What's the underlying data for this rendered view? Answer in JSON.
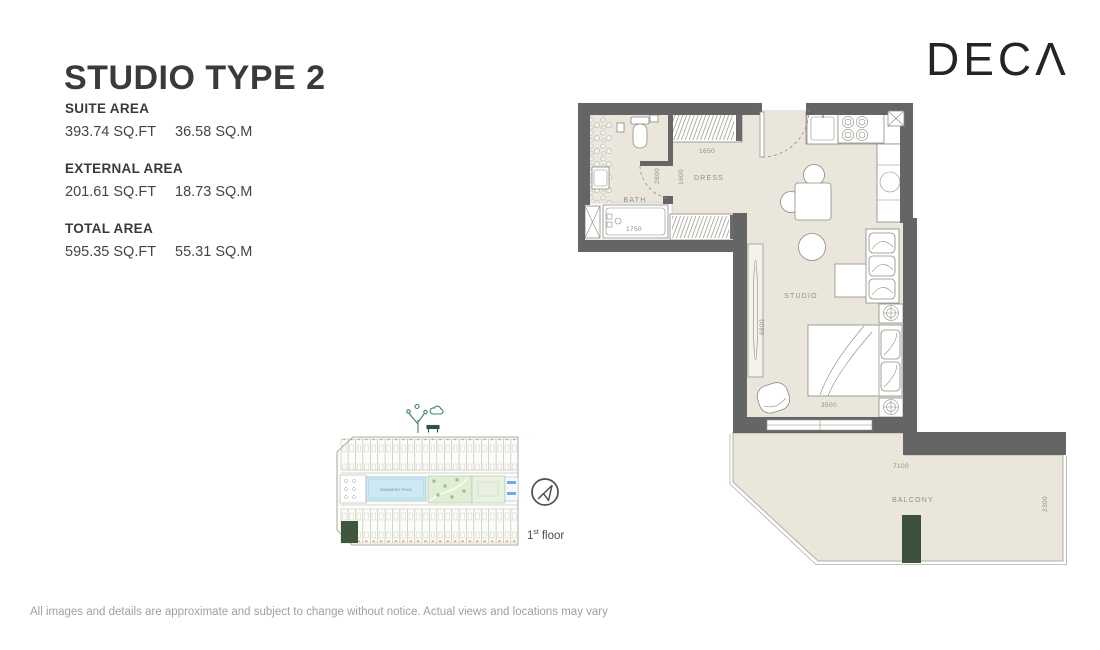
{
  "header": {
    "title": "STUDIO TYPE 2",
    "brand": "DECΛ"
  },
  "areas": [
    {
      "label": "SUITE AREA",
      "sqft": "393.74 SQ.FT",
      "sqm": "36.58 SQ.M"
    },
    {
      "label": "EXTERNAL AREA",
      "sqft": "201.61 SQ.FT",
      "sqm": "18.73 SQ.M"
    },
    {
      "label": "TOTAL AREA",
      "sqft": "595.35 SQ.FT",
      "sqm": "55.31 SQ.M"
    }
  ],
  "floor_plan": {
    "labels": {
      "bath": "BATH",
      "dress": "DRESS",
      "studio": "STUDIO",
      "balcony": "BALCONY"
    },
    "dims": {
      "wardrobe": "1650",
      "dress_width": "2800",
      "dress_length": "1600",
      "bath_length": "1750",
      "studio_length": "6800",
      "studio_width": "3500",
      "balcony_width": "7100",
      "balcony_depth": "2300"
    }
  },
  "key_plan": {
    "pool_label": "SWIMMING POOL",
    "floor_num": "1",
    "floor_sup": "st",
    "floor_word": "floor"
  },
  "footer": {
    "disclaimer": "All images and details are approximate and subject to change without notice. Actual views and locations may vary"
  },
  "colors": {
    "wall": "#656565",
    "floor": "#ebe6dc",
    "accent_green": "#3d5140",
    "pool_blue": "#cde8f3",
    "label_gray": "#8f9086"
  }
}
